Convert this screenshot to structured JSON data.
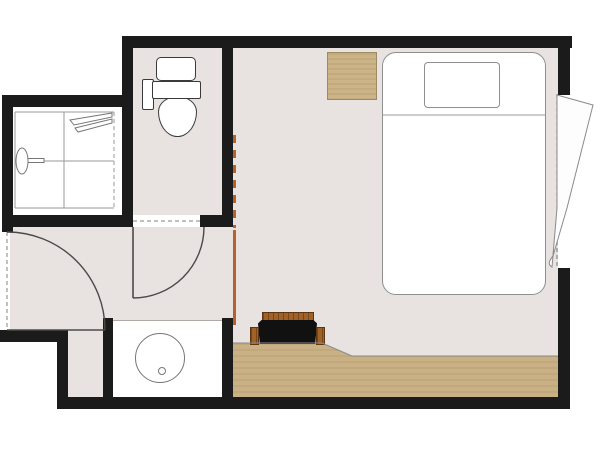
{
  "meta": {
    "title": "Hotel room floor plan",
    "figure_type": "architectural floor plan, top view, no text labels",
    "canvas": {
      "width": 600,
      "height": 450
    }
  },
  "colors": {
    "background": "#ffffff",
    "wall": "#1b1b1b",
    "carpet_floor": "#e8e2e1",
    "fixture_fill": "#ffffff",
    "wood_floor": "#c9b185",
    "wood_edge": "#8b8b8b",
    "nightstand_wood": "#cdb488",
    "nightstand_border": "#9c8a61",
    "bench_wood": "#a06226",
    "bench_seat": "#111111",
    "sliding_door": "#b5622f",
    "fixture_line": "#777777",
    "door_line": "#4a4a4a",
    "dash_line": "#9a9a9a",
    "bed_line": "#8f8f8f"
  },
  "rooms": [
    {
      "id": "bedroom",
      "label": "Bedroom",
      "floor": "carpet"
    },
    {
      "id": "entry-hall",
      "label": "Entry hall",
      "floor": "carpet"
    },
    {
      "id": "toilet-room",
      "label": "Toilet room",
      "floor": "carpet"
    },
    {
      "id": "shower-room",
      "label": "Shower stall room",
      "floor": "white tile"
    },
    {
      "id": "vanity-nook",
      "label": "Washbasin counter nook",
      "floor": "white counter"
    }
  ],
  "furniture_and_fixtures": [
    {
      "id": "double-bed",
      "label": "Double bed with pillow and sheet fold line",
      "room": "bedroom"
    },
    {
      "id": "nightstand",
      "label": "Square wooden side table",
      "room": "bedroom"
    },
    {
      "id": "bench",
      "label": "Black bench with wooden back and armrests",
      "room": "bedroom"
    },
    {
      "id": "wood-flooring-strip",
      "label": "Wood flooring strip with angled step",
      "room": "bedroom"
    },
    {
      "id": "window-curtain",
      "label": "Window with drawn curtain panel",
      "room": "bedroom"
    },
    {
      "id": "toilet",
      "label": "Toilet with tank, flush unit and bowl",
      "room": "toilet-room"
    },
    {
      "id": "shower",
      "label": "Shower stall with faucet, slide bar and glass door",
      "room": "shower-room"
    },
    {
      "id": "washbasin",
      "label": "Round washbasin with drain",
      "room": "vanity-nook"
    }
  ],
  "openings": [
    {
      "id": "entry-door",
      "type": "hinged door, quarter-circle swing",
      "location": "left wall of entry hall"
    },
    {
      "id": "toilet-door",
      "type": "hinged door, quarter-circle swing",
      "location": "bottom wall of toilet room"
    },
    {
      "id": "sliding-door",
      "type": "orange sliding partition with dashed track",
      "location": "between entry hall and bedroom"
    },
    {
      "id": "window",
      "type": "window opening with dashed sill line",
      "location": "right wall of bedroom"
    }
  ]
}
